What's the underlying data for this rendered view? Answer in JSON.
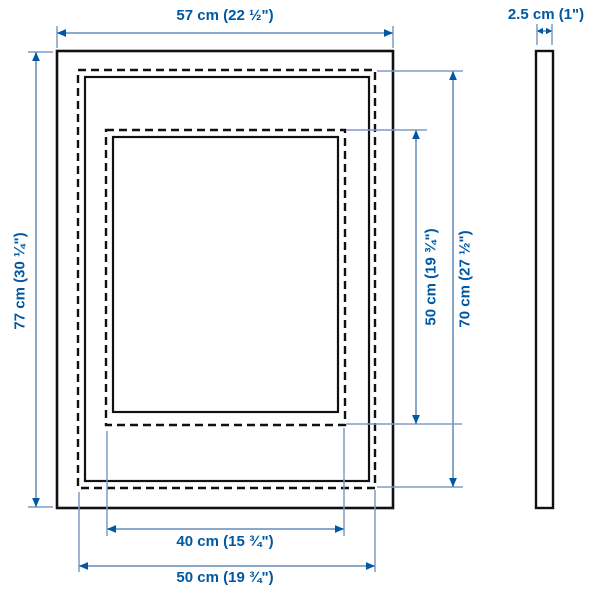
{
  "diagram": {
    "type": "product-dimension-diagram",
    "views": {
      "front": "frame front view",
      "side": "frame side profile"
    },
    "dimensions": {
      "total_width": "57 cm (22 ½\")",
      "total_height": "77 cm (30 ¼\")",
      "depth": "2.5 cm (1\")",
      "opening_height": "50 cm (19 ¾\")",
      "picture_height": "70 cm (27 ½\")",
      "opening_width": "40 cm (15 ¾\")",
      "picture_width": "50 cm (19 ¾\")"
    },
    "colors": {
      "label_text": "#0058a3",
      "arrowhead": "#0058a3",
      "dimension_line": "#7e9bc5",
      "frame_outline": "#111111",
      "background": "#ffffff"
    }
  }
}
